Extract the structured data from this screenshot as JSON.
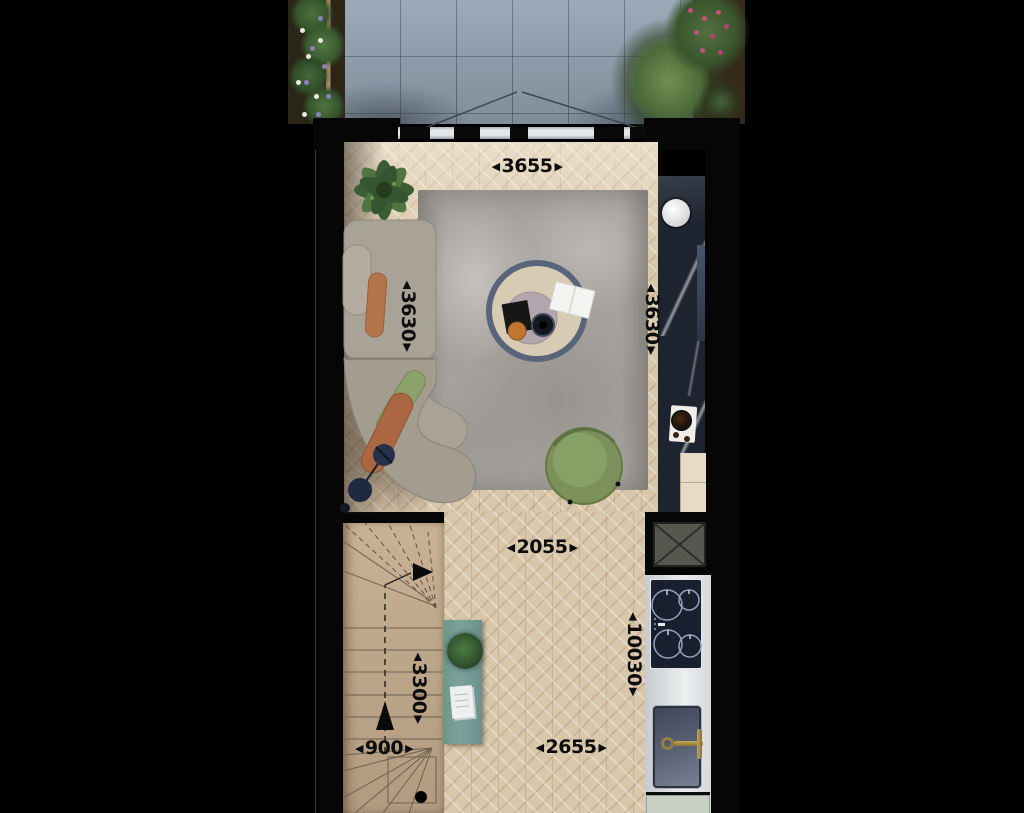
{
  "glyphs": {
    "arrow_left": "◀",
    "arrow_right": "▶"
  },
  "plan": {
    "dimensions": [
      {
        "id": "terrace-opening-width",
        "value": "3655",
        "orientation": "horizontal"
      },
      {
        "id": "living-room-depth-left",
        "value": "3630",
        "orientation": "vertical"
      },
      {
        "id": "kitchen-run-depth-right",
        "value": "3630",
        "orientation": "vertical"
      },
      {
        "id": "hallway-width-upper",
        "value": "2055",
        "orientation": "horizontal"
      },
      {
        "id": "total-plan-depth",
        "value": "10030",
        "orientation": "vertical"
      },
      {
        "id": "staircase-length",
        "value": "3300",
        "orientation": "vertical"
      },
      {
        "id": "staircase-width",
        "value": "900",
        "orientation": "horizontal"
      },
      {
        "id": "hallway-width-lower",
        "value": "2655",
        "orientation": "horizontal"
      }
    ],
    "colors": {
      "background": "#000000",
      "wall": "#060606",
      "parquet_floor": "#d9c7ab",
      "terrace_tile": "#91a0b0",
      "rug": "#a5a19c",
      "sofa": "#a9a296",
      "marble_counter": "#1d2430",
      "stairs": "#c2ab8e",
      "console_table": "#7ba29b",
      "armchair": "#7d925c",
      "pillow_terracotta": "#b5754c",
      "pillow_green": "#8ea36c",
      "faucet_brass": "#a8893f",
      "dimension_text": "#0d0d0d"
    }
  }
}
